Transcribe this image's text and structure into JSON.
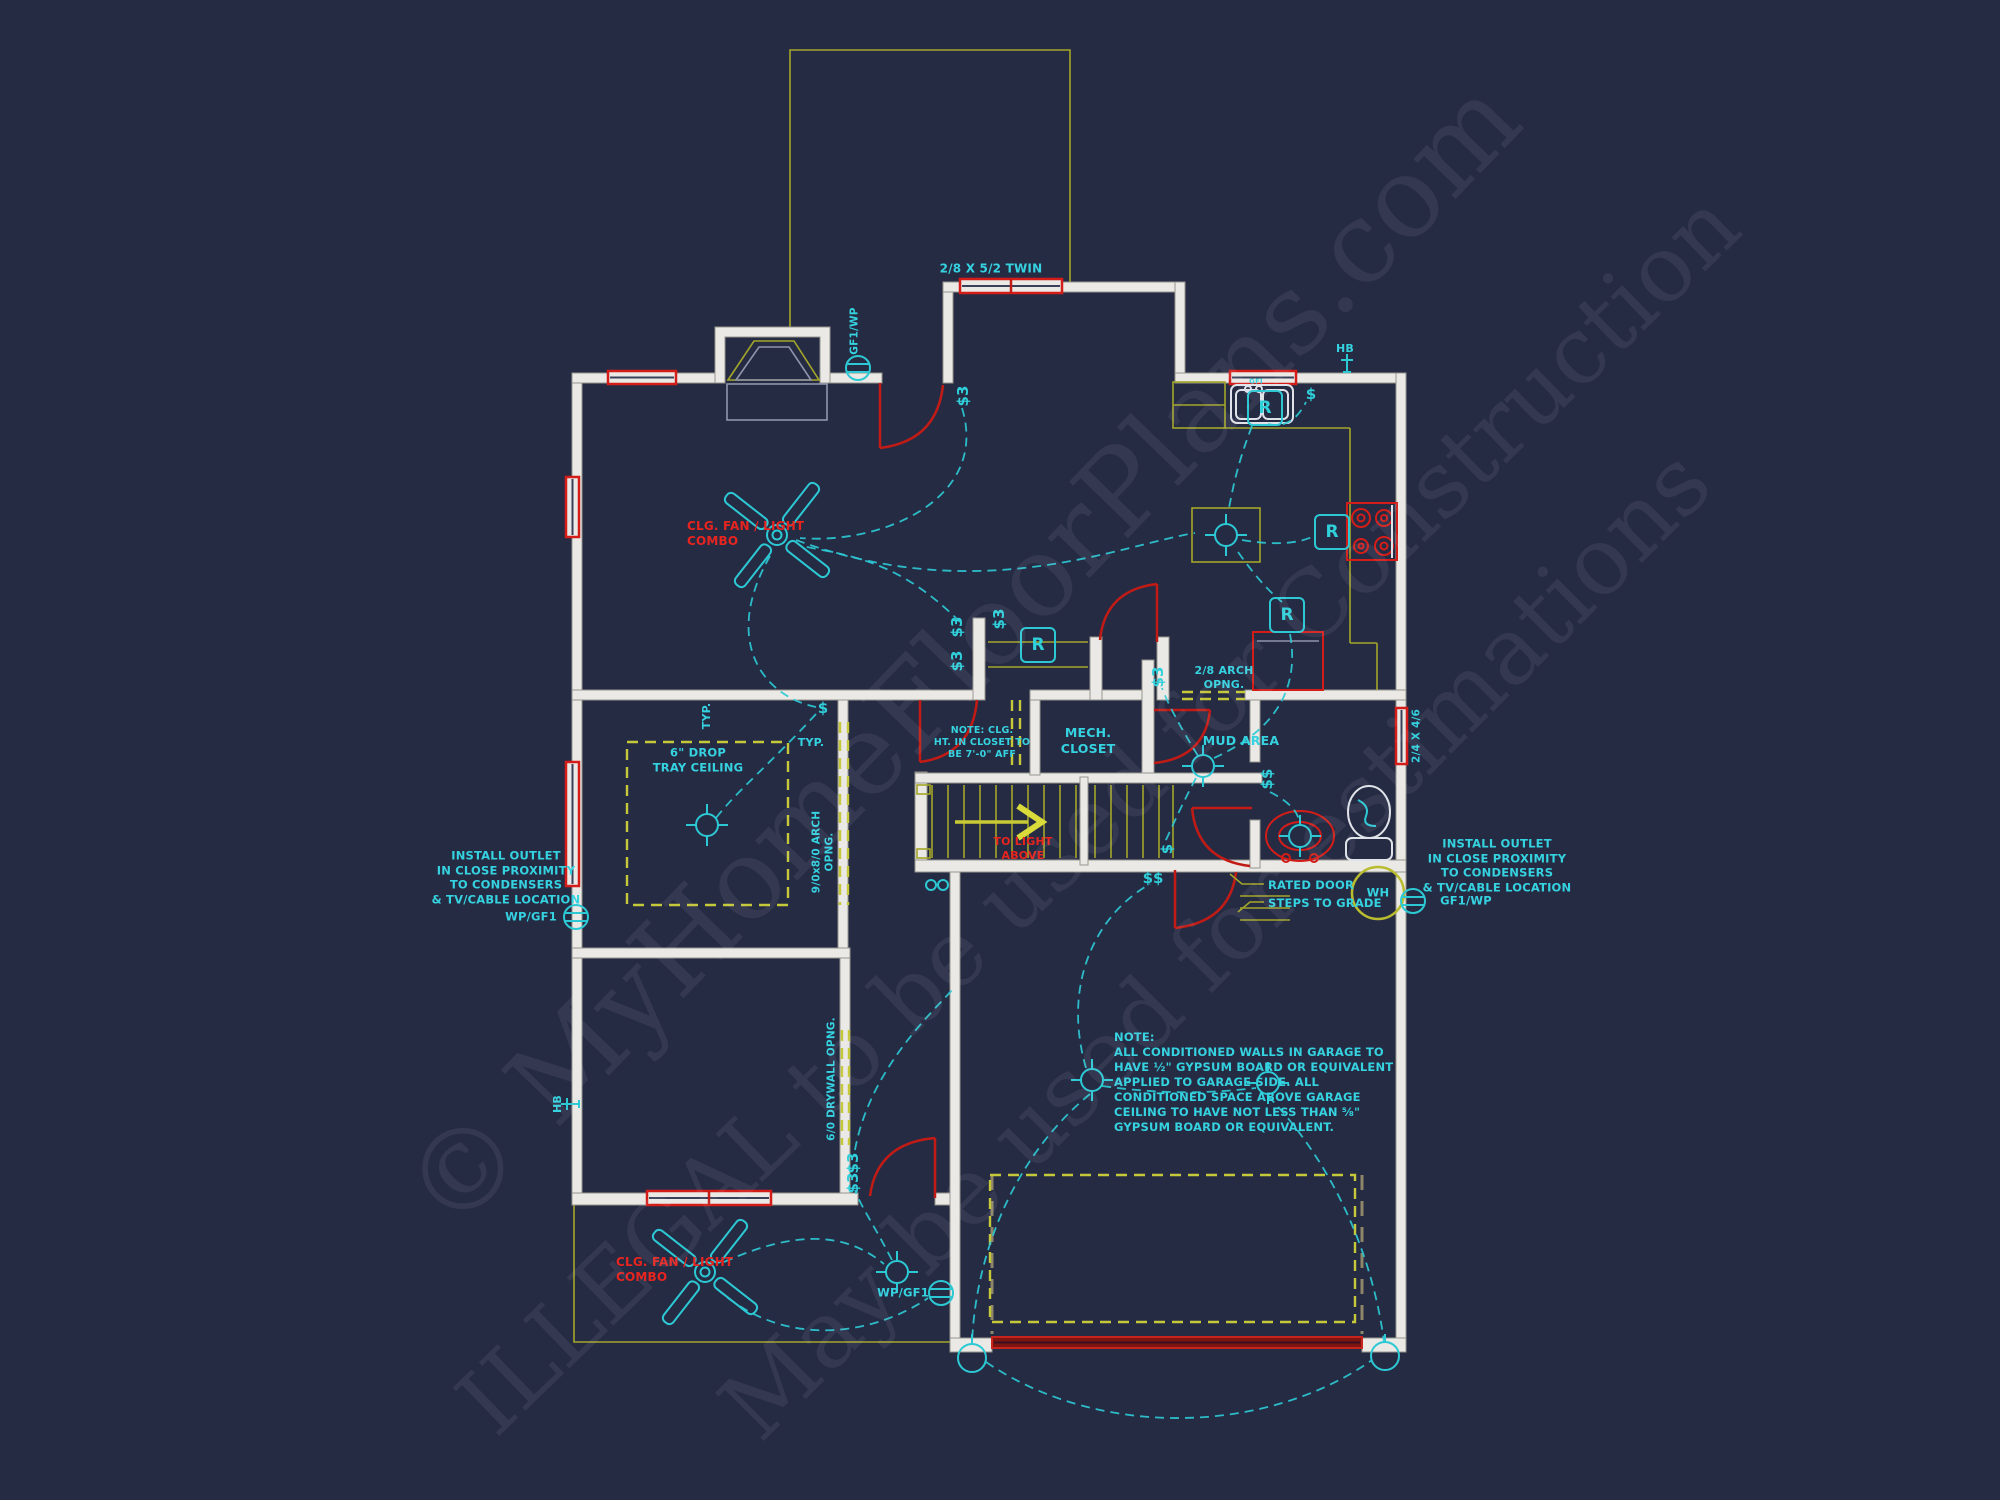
{
  "colors": {
    "background": "#262b44",
    "wall": "#eae9e5",
    "cad_yellow": "#b9bc2e",
    "cad_red": "#d41d18",
    "cad_cyan": "#2fd0da",
    "red_text": "#e8241f"
  },
  "watermarks": {
    "copyright": "© MyHomeFloorPlans.com",
    "illegal": "ILLEGAL to be used for Construction",
    "estimations": "May be used for estimations"
  },
  "labels": {
    "twin_window": "2/8 X 5/2 TWIN",
    "window_2446": "2/4 X 4/6",
    "arch_opening_28": "2/8 ARCH\nOPNG.",
    "arch_opening_9080": "9/0x8/0 ARCH\nOPNG.",
    "drywall_opening": "6/0 DRYWALL OPNG.",
    "mech_closet": "MECH.\nCLOSET",
    "mud_area": "MUD AREA",
    "closet_note": "NOTE: CLG.\nHT. IN CLOSET TO\nBE 7'-0\" AFF",
    "garage_note": "NOTE:\nALL CONDITIONED WALLS IN GARAGE TO\nHAVE ½\" GYPSUM BOARD OR EQUIVALENT\nAPPLIED TO GARAGE SIDE.  ALL\nCONDITIONED SPACE ABOVE GARAGE\nCEILING TO HAVE NOT LESS THAN ⅝\"\nGYPSUM BOARD OR EQUIVALENT.",
    "install_outlet": "INSTALL OUTLET\nIN CLOSE PROXIMITY\nTO CONDENSERS\n& TV/CABLE LOCATION",
    "ceiling_fan_combo": "CLG. FAN / LIGHT\nCOMBO",
    "to_light_above": "TO LIGHT\nABOVE",
    "rated_door": "RATED DOOR",
    "steps_to_grade": "STEPS TO GRADE",
    "drop_tray": "6\" DROP\nTRAY CEILING",
    "typ": "TYP.",
    "wp_gf1": "WP/GF1",
    "gf1_wp": "GF1/WP",
    "wh": "WH",
    "hb": "HB",
    "gfi": "GFI"
  },
  "symbols": {
    "switch": "$",
    "switch_double": "$$",
    "switch_3way": "$3",
    "recessed": "R"
  }
}
